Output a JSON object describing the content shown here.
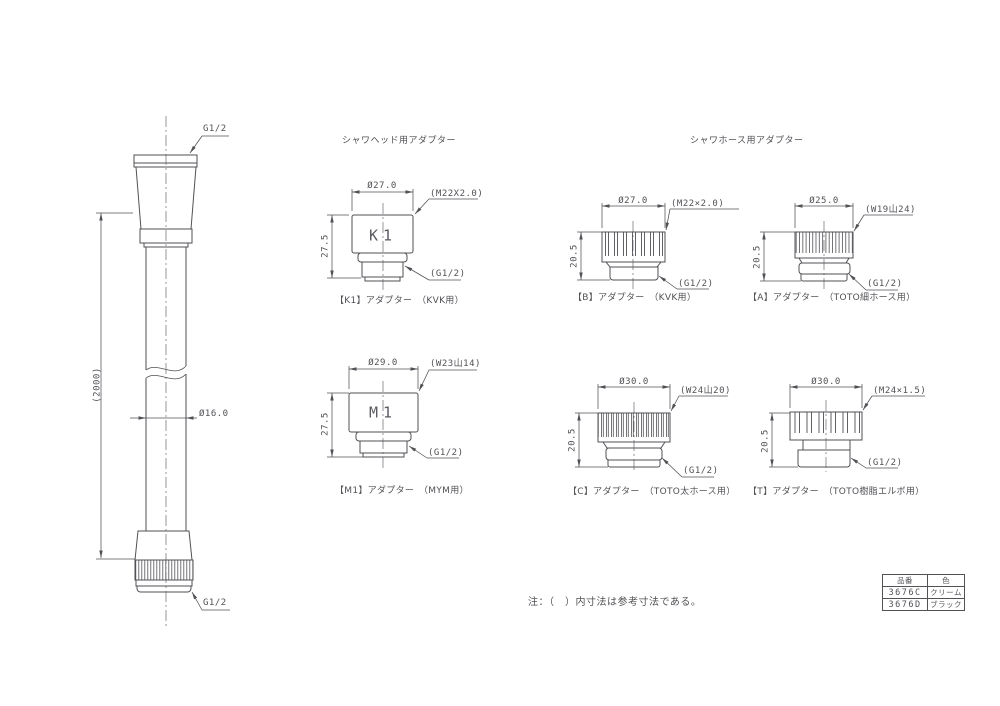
{
  "sections": {
    "head_title": "シャワヘッド用アダプター",
    "hose_title": "シャワホース用アダプター"
  },
  "hose": {
    "top_thread": "G1/2",
    "bottom_thread": "G1/2",
    "length_dim": "(2000)",
    "diameter_dim": "Ø16.0"
  },
  "adapters": [
    {
      "id": "K1",
      "label": "K1",
      "diameter": "Ø27.0",
      "thread": "(M22X2.0)",
      "height": "27.5",
      "outlet": "(G1/2)",
      "caption": "【K1】アダプター　（KVK用）"
    },
    {
      "id": "M1",
      "label": "M1",
      "diameter": "Ø29.0",
      "thread": "(W23山14)",
      "height": "27.5",
      "outlet": "(G1/2)",
      "caption": "【M1】アダプター　（MYM用）"
    },
    {
      "id": "B",
      "diameter": "Ø27.0",
      "thread": "(M22×2.0)",
      "height": "20.5",
      "outlet": "(G1/2)",
      "caption": "【B】アダプター　（KVK用）"
    },
    {
      "id": "A",
      "diameter": "Ø25.0",
      "thread": "(W19山24)",
      "height": "20.5",
      "outlet": "(G1/2)",
      "caption": "【A】アダプター　（TOTO細ホース用）"
    },
    {
      "id": "C",
      "diameter": "Ø30.0",
      "thread": "(W24山20)",
      "height": "20.5",
      "outlet": "(G1/2)",
      "caption": "【C】アダプター　（TOTO太ホース用）"
    },
    {
      "id": "T",
      "diameter": "Ø30.0",
      "thread": "(M24×1.5)",
      "height": "20.5",
      "outlet": "(G1/2)",
      "caption": "【T】アダプター　（TOTO樹脂エルボ用）"
    }
  ],
  "note": "注：（　）内寸法は参考寸法である。",
  "table": {
    "headers": [
      "品番",
      "色"
    ],
    "rows": [
      [
        "3676C",
        "クリーム"
      ],
      [
        "3676D",
        "ブラック"
      ]
    ]
  },
  "colors": {
    "line": "#515156",
    "text": "#515156",
    "background": "#ffffff"
  }
}
